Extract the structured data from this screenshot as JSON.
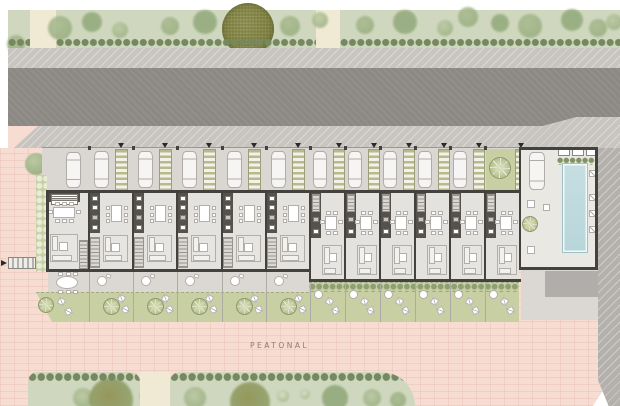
{
  "title": "Residential row-house site plan",
  "labels": {
    "pedestrian_street": "PEATONAL"
  },
  "colors": {
    "park": "#cfd8bf",
    "path": "#f0ead4",
    "hedge": "#76885f",
    "bush1": "#a9ba8e",
    "bush2": "#93a97b",
    "bush3": "#bcc9a2",
    "bushPale": "#dde4c9",
    "olive": "#8e9150",
    "oliveDark": "#6f7338",
    "sidewalk": "#c8c4c0",
    "road": "#8c8984",
    "band": "#b4b1ad",
    "plaza": "#f6dcd1",
    "brick": "rgba(205,145,125,0.16)",
    "wall": "#44423f",
    "floor": "#e4e2de",
    "driveway": "#dad7d3",
    "car": "#f6f5f3",
    "carBorder": "#b0ada9",
    "pergolaStripe": "#b6ba8c",
    "pergolaBg": "#f2f1ea",
    "core": "#55524d",
    "appliance": "#ffffff",
    "stairBg": "#dbd8d3",
    "stairLine": "#97948f",
    "furn": "#eceae6",
    "furnBorder": "#b2afab",
    "white": "#ffffff",
    "terrace": "#dbd8d3",
    "garden": "#c8cfa3",
    "gardenLine": "#a3ab84",
    "treeFill": "#b9c393",
    "treeEdge": "#8f9a6e",
    "pool": "#b7d6da",
    "poolEdge": "#9fc0c4",
    "deck": "#eae8e3",
    "pad": "#b0adaa",
    "divider": "#aeaba6",
    "text": "#8a7e73"
  },
  "park_top": {
    "x": 8,
    "y": 10,
    "w": 612,
    "h": 38,
    "paths": [
      {
        "x": 30,
        "w": 26
      },
      {
        "x": 316,
        "w": 24
      }
    ],
    "hedge_segments": [
      [
        8,
        30
      ],
      [
        56,
        316
      ],
      [
        340,
        620
      ]
    ],
    "big_tree": {
      "cx": 248,
      "cy": 29,
      "r": 26
    },
    "bushes": [
      [
        16,
        44,
        9,
        1
      ],
      [
        60,
        28,
        12,
        1
      ],
      [
        92,
        22,
        10,
        2
      ],
      [
        120,
        30,
        8,
        3
      ],
      [
        170,
        26,
        9,
        1
      ],
      [
        205,
        22,
        12,
        2
      ],
      [
        290,
        26,
        10,
        1
      ],
      [
        320,
        20,
        8,
        3
      ],
      [
        365,
        25,
        9,
        1
      ],
      [
        405,
        22,
        12,
        2
      ],
      [
        445,
        28,
        8,
        3
      ],
      [
        468,
        17,
        10,
        1
      ],
      [
        500,
        23,
        9,
        2
      ],
      [
        530,
        26,
        12,
        1
      ],
      [
        572,
        20,
        11,
        2
      ],
      [
        598,
        28,
        9,
        1
      ],
      [
        614,
        22,
        8,
        3
      ],
      [
        262,
        42,
        9,
        2
      ]
    ]
  },
  "sidewalk_top": {
    "x": 8,
    "y": 48,
    "w": 612,
    "h": 20
  },
  "road": {
    "x": 8,
    "y": 68,
    "w": 612,
    "h": 58,
    "diag_x1": 543,
    "diag_x2": 577,
    "right_bottom_y": 117
  },
  "sidewalk_low": {
    "x": 8,
    "y": 117,
    "w": 612,
    "h": 31
  },
  "plaza": {
    "x": 0,
    "y": 148,
    "w": 608,
    "h": 258
  },
  "right_band": {
    "x": 598,
    "y": 148,
    "w": 22,
    "h": 258
  },
  "pink_wedge": {
    "x": 8,
    "y": 126,
    "w": 30,
    "h": 24
  },
  "corner_tree": {
    "cx": 36,
    "cy": 164,
    "r": 11
  },
  "crossing": {
    "x": 8,
    "y": 257,
    "w": 28,
    "h": 12
  },
  "bottom_islands": {
    "path_between": {
      "x": 140,
      "w": 30
    },
    "islands": [
      {
        "x": 28,
        "w": 112,
        "r": "10px 10px 0 0",
        "bushes": [
          [
            55,
            26,
            10,
            3
          ],
          [
            83,
            28,
            22,
            0
          ],
          [
            120,
            24,
            8,
            1
          ]
        ]
      },
      {
        "x": 170,
        "w": 245,
        "r": "10px 34px 0 0",
        "bushes": [
          [
            25,
            26,
            11,
            3
          ],
          [
            80,
            30,
            20,
            0
          ],
          [
            113,
            24,
            6,
            4
          ],
          [
            135,
            22,
            5,
            4
          ],
          [
            165,
            26,
            13,
            2
          ],
          [
            202,
            26,
            9,
            3
          ],
          [
            228,
            28,
            8,
            1
          ]
        ]
      }
    ],
    "y": 372,
    "h": 34
  },
  "houses": {
    "driveway": {
      "x": 42,
      "y": 148,
      "w": 556,
      "h": 44
    },
    "left_section": {
      "walls": [
        88,
        132,
        176,
        221,
        265
      ],
      "right_edge": 309,
      "unit_w": 44,
      "top_y": 190,
      "bottom_y": 269,
      "car": {
        "dx": 6,
        "y": 151,
        "w": 15,
        "h": 37
      },
      "pergola": {
        "dx": 27,
        "w": 13
      },
      "terrace": {
        "y": 271,
        "h": 21
      },
      "garden": {
        "y": 292,
        "h": 30
      }
    },
    "right_section": {
      "walls": [
        309,
        344,
        379,
        414,
        449,
        484
      ],
      "right_edge": 519,
      "unit_w": 35,
      "top_y": 190,
      "bottom_y": 279,
      "car": {
        "dx": 4,
        "y": 151,
        "w": 14,
        "h": 37
      },
      "pergola": {
        "dx": 24,
        "w": 12
      },
      "garden": {
        "y": 282,
        "h": 40
      },
      "patio_unit_index": 5,
      "patio": {
        "x": 486,
        "y": 149,
        "w": 29,
        "h": 42,
        "tree": [
          500,
          168,
          11
        ]
      }
    },
    "end_unit": {
      "left_wall": 46,
      "hedge_strip": {
        "x": 36,
        "y": 175,
        "w": 11,
        "h": 97
      },
      "car": {
        "x": 66,
        "y": 152,
        "w": 15,
        "h": 36
      },
      "garden_tree": [
        46,
        305,
        8
      ],
      "loungers": [
        [
          58,
          298,
          25
        ],
        [
          65,
          308,
          -20
        ]
      ]
    },
    "pool_unit": {
      "x": 519,
      "w": 79,
      "floor_y": 148,
      "bottom_y": 267,
      "car": {
        "x": 529,
        "y": 152,
        "w": 16,
        "h": 38
      },
      "pool": {
        "x": 562,
        "y": 163,
        "w": 26,
        "h": 90
      },
      "planters": [
        [
          558,
          149,
          12
        ],
        [
          572,
          149,
          12
        ],
        [
          586,
          149,
          10
        ]
      ],
      "loungers_y": [
        170,
        194,
        210,
        226
      ],
      "loungers_x": 589,
      "parasol_table": [
        530,
        224,
        8
      ],
      "small_tables": [
        [
          527,
          200,
          8
        ],
        [
          527,
          246,
          8
        ],
        [
          543,
          204,
          7
        ]
      ],
      "pad": {
        "x": 545,
        "y": 271,
        "w": 53,
        "h": 26
      },
      "terrace": {
        "x": 521,
        "y": 269,
        "w": 77,
        "h": 51
      }
    }
  }
}
